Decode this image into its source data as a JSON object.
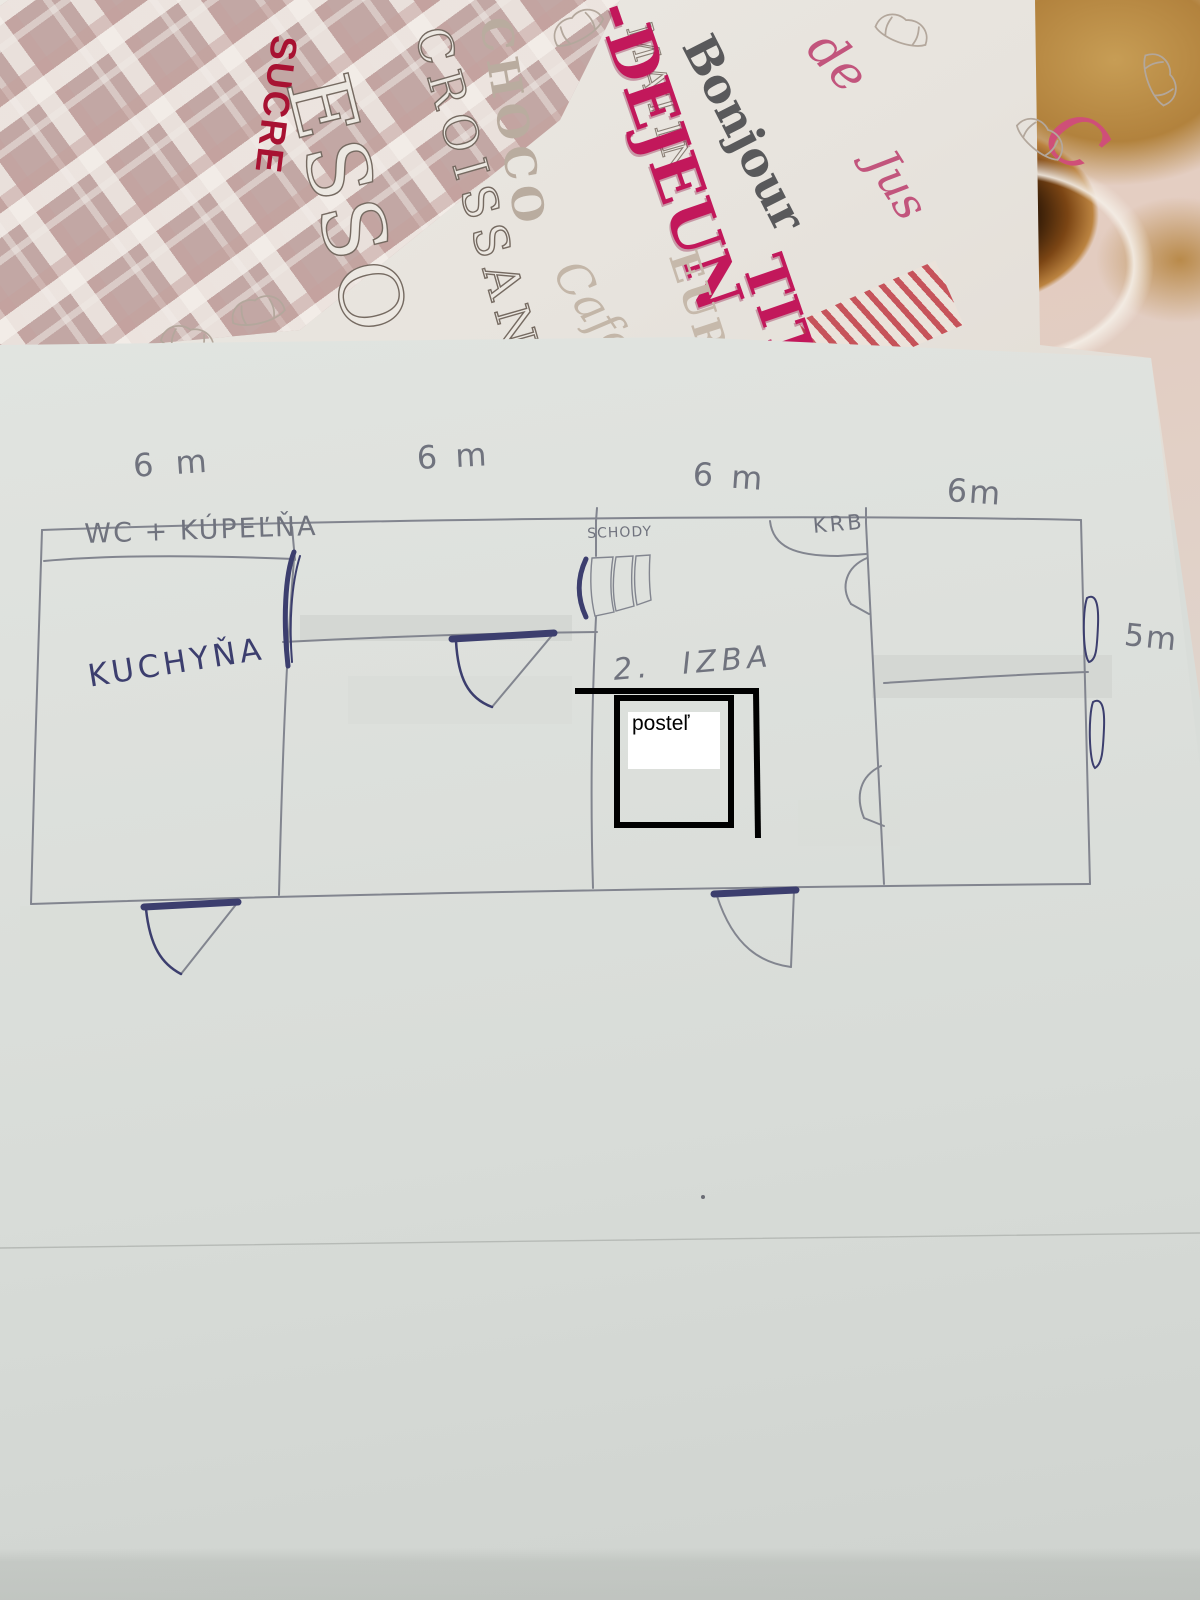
{
  "magazine": {
    "words": {
      "sucre": "SUCRE",
      "esso": "ESSO",
      "croissant": "CROISSANT",
      "choco": "CHOCO",
      "matin": "MATIN",
      "dejeun": "-DEJEUN",
      "tit": "TIT",
      "bonjour": "Bonjour",
      "de": "de",
      "jus": "Jus",
      "eurre": "EURRE",
      "cafe": "Cafe",
      "curl": "C"
    }
  },
  "plan": {
    "dims": {
      "top": [
        "6 m",
        "6 m",
        "6 m",
        "6m"
      ],
      "right": "5m"
    },
    "rooms": {
      "wc": "WC + KÚPEĽŇA",
      "kitchen": "KUCHYŇA",
      "stairs": "SCHODY",
      "fireplace": "KRB",
      "room2": "2. IZBA"
    },
    "overlay": {
      "bed_label": "posteľ"
    },
    "colors": {
      "pencil": "#82858f",
      "pen": "#3c3e6e",
      "overlay_black": "#000000",
      "accent_red": "#a81232",
      "accent_pink": "#c2185b"
    }
  }
}
